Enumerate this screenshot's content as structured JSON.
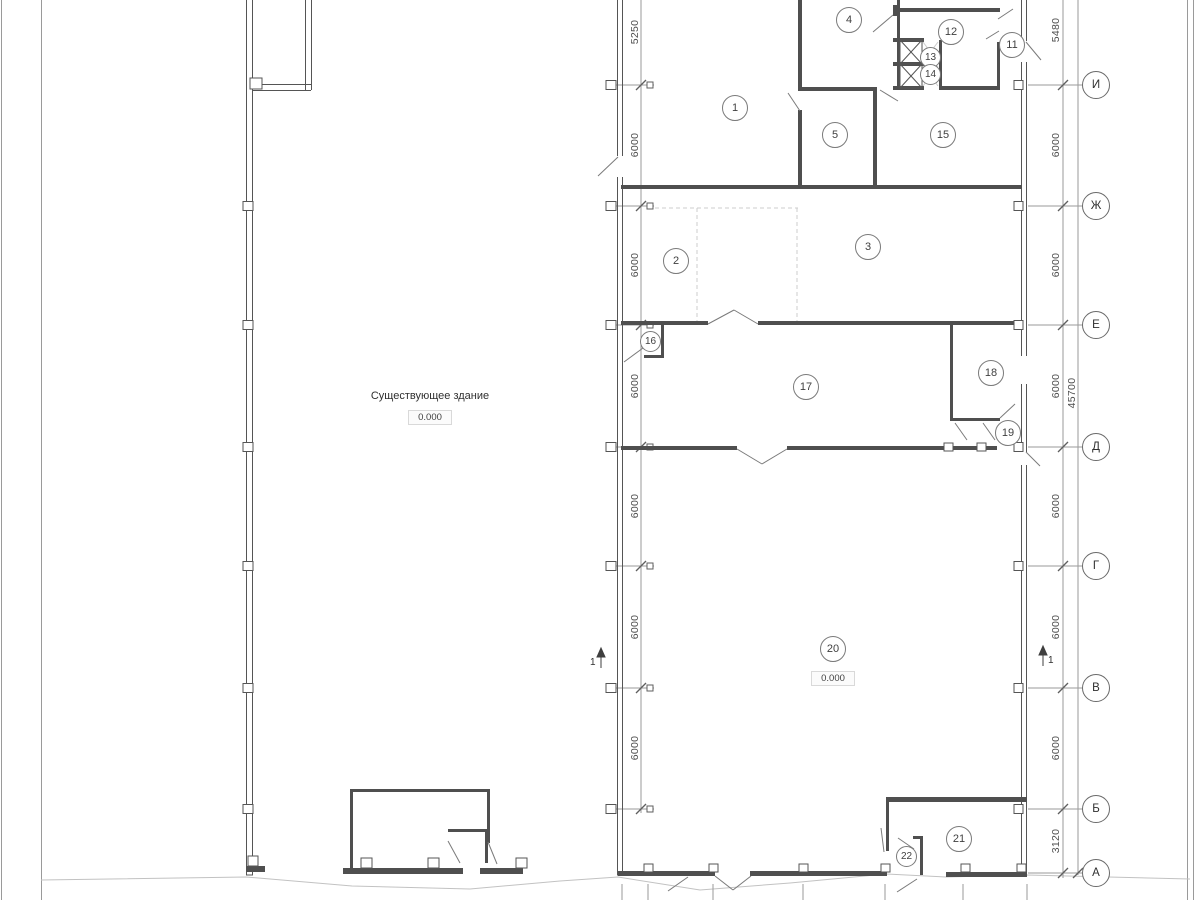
{
  "colors": {
    "wall": "#4f4f4f",
    "thin_line": "#9a9a9a",
    "light_line": "#cccccc",
    "text": "#3f3f3f",
    "background": "#ffffff"
  },
  "plan": {
    "existing_building_label": "Существующее здание",
    "existing_building_elevation": "0.000",
    "hall_elevation": "0.000",
    "section_mark": "1"
  },
  "rooms": [
    "1",
    "2",
    "3",
    "4",
    "5",
    "11",
    "12",
    "13",
    "14",
    "15",
    "16",
    "17",
    "18",
    "19",
    "20",
    "21",
    "22"
  ],
  "axes": [
    "И",
    "Ж",
    "Е",
    "Д",
    "Г",
    "В",
    "Б",
    "А"
  ],
  "dimensions": {
    "left": [
      "5250",
      "6000",
      "6000",
      "6000",
      "6000",
      "6000",
      "6000"
    ],
    "right": [
      "5480",
      "6000",
      "6000",
      "6000",
      "6000",
      "6000",
      "6000",
      "3120"
    ],
    "total": "45700"
  }
}
